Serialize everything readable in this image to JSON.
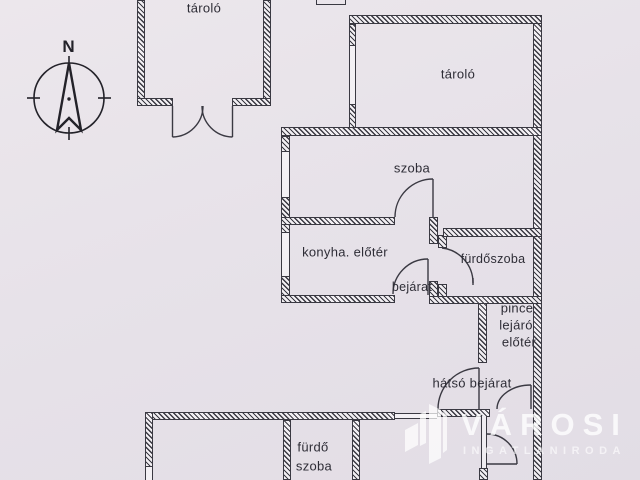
{
  "colors": {
    "background": "#e6e1e8",
    "wall_line": "#3a3942",
    "label_text": "#2e2d36",
    "watermark": "#ffffff"
  },
  "compass": {
    "north_label": "N"
  },
  "rooms": {
    "storage_upper": {
      "label": "tároló"
    },
    "storage_right": {
      "label": "tároló"
    },
    "room": {
      "label": "szoba"
    },
    "kitchen_foyer": {
      "label": "konyha. előtér"
    },
    "bathroom": {
      "label": "fürdőszoba"
    },
    "entrance": {
      "label": "bejárat"
    },
    "cellar_landing": {
      "line1": "pince",
      "line2": "lejáró",
      "line3": "előtér"
    },
    "back_entrance": {
      "label": "hátsó bejárat"
    },
    "bath": {
      "line1": "fürdő",
      "line2": "szoba"
    }
  },
  "watermark": {
    "brand": "VÁROSI",
    "tagline": "INGATLANIRODA"
  }
}
